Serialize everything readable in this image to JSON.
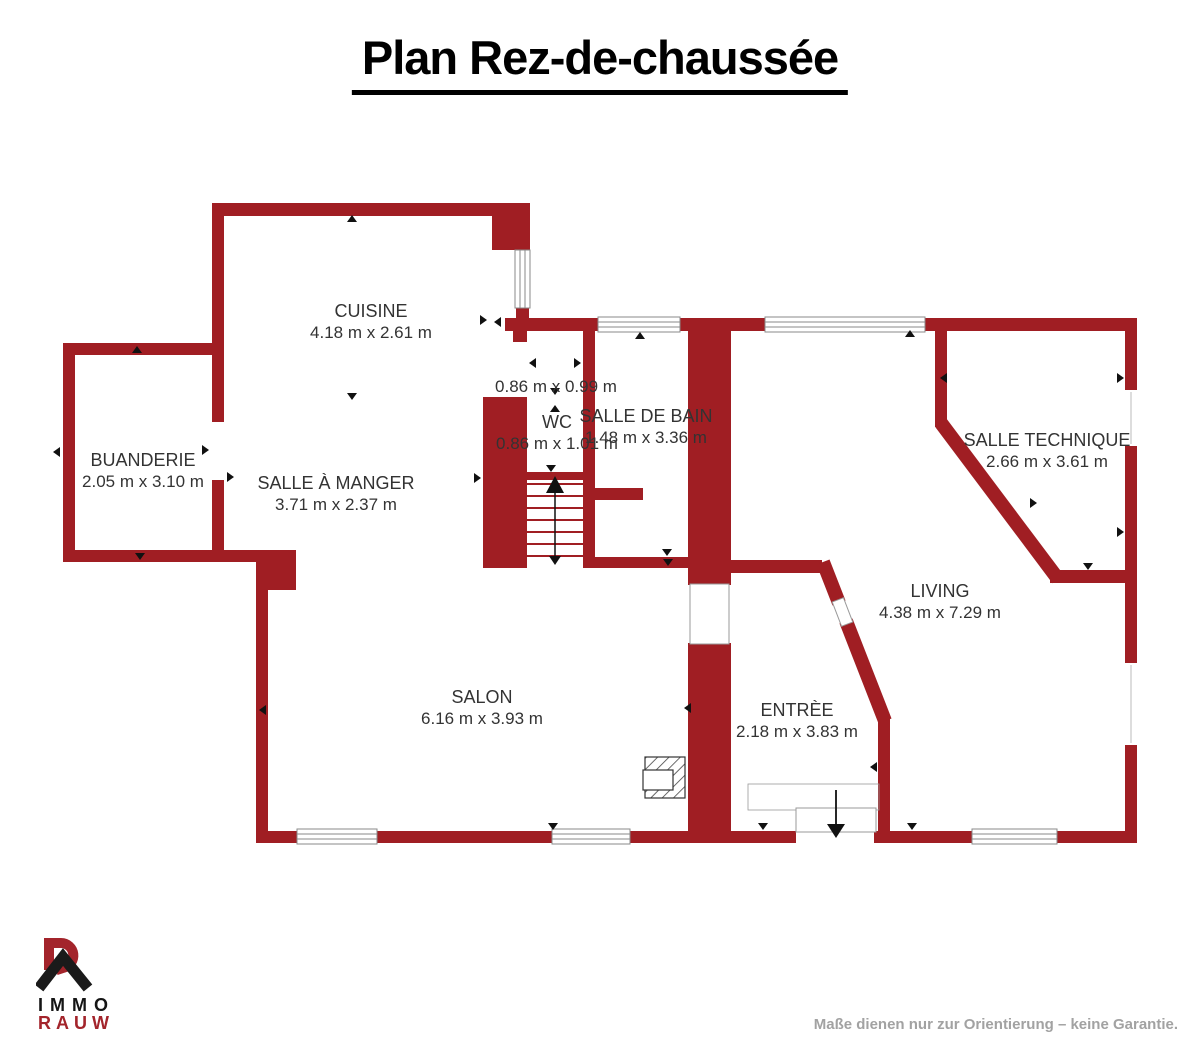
{
  "title": "Plan Rez-de-chaussée",
  "rooms": [
    {
      "id": "cuisine",
      "name": "CUISINE",
      "dims": "4.18 m x 2.61 m"
    },
    {
      "id": "buanderie",
      "name": "BUANDERIE",
      "dims": "2.05 m x 3.10 m"
    },
    {
      "id": "salle-a-manger",
      "name": "SALLE À MANGER",
      "dims": "3.71 m x 2.37 m"
    },
    {
      "id": "vestibule",
      "name": "",
      "dims": "0.86 m x 0.99 m"
    },
    {
      "id": "wc",
      "name": "WC",
      "dims": "0.86 m x 1.01 m"
    },
    {
      "id": "salle-de-bain",
      "name": "SALLE DE BAIN",
      "dims": "1.48 m x 3.36 m"
    },
    {
      "id": "salle-technique",
      "name": "SALLE TECHNIQUE",
      "dims": "2.66 m x 3.61 m"
    },
    {
      "id": "living",
      "name": "LIVING",
      "dims": "4.38 m x 7.29 m"
    },
    {
      "id": "salon",
      "name": "SALON",
      "dims": "6.16 m x 3.93 m"
    },
    {
      "id": "entree",
      "name": "ENTRÈE",
      "dims": "2.18 m x 3.83 m"
    }
  ],
  "logo": {
    "line1": "IMMO",
    "line2": "RAUW"
  },
  "footer": {
    "disclaimer": "Maße dienen nur zur Orientierung – keine Garantie."
  },
  "colors": {
    "wall_red": "#A01E23",
    "logo_red": "#A3242B",
    "label_gray": "#333333",
    "footer_gray": "#A2A2A2"
  }
}
